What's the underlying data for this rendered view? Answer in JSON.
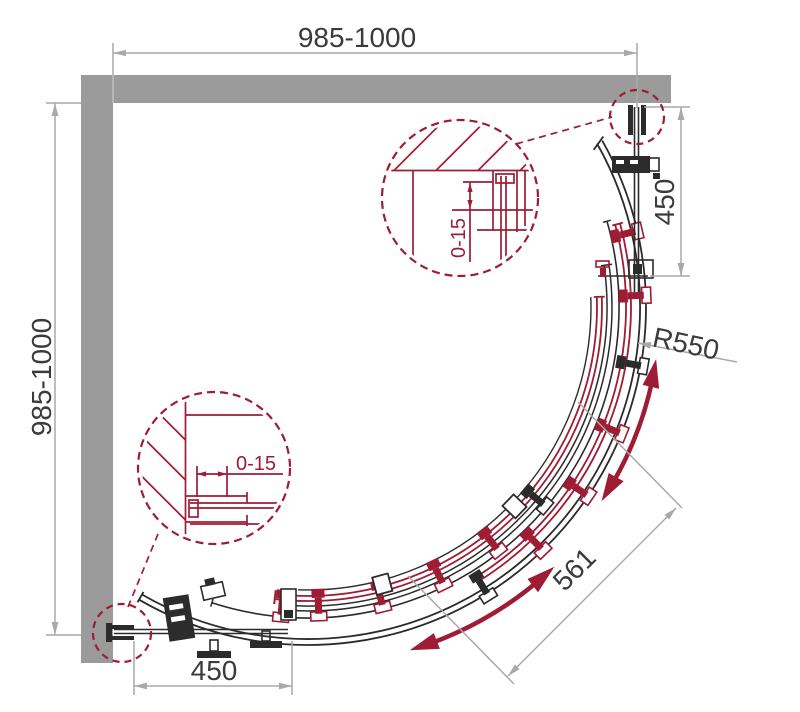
{
  "title": "Quadrant shower enclosure technical drawing",
  "dims": {
    "top_wall": "985-1000",
    "left_wall": "985-1000",
    "right_panel": "450",
    "bottom_panel": "450",
    "radius": "R550",
    "door_width": "561"
  },
  "details": {
    "top": {
      "adjustment": "0-15"
    },
    "bottom": {
      "adjustment": "0-15"
    }
  },
  "colors": {
    "wall": "#9b9b9b",
    "line": "#2b2b2b",
    "dim": "#a9a9a9",
    "text": "#3b3b3b",
    "accent_red": "#9e1c34"
  }
}
